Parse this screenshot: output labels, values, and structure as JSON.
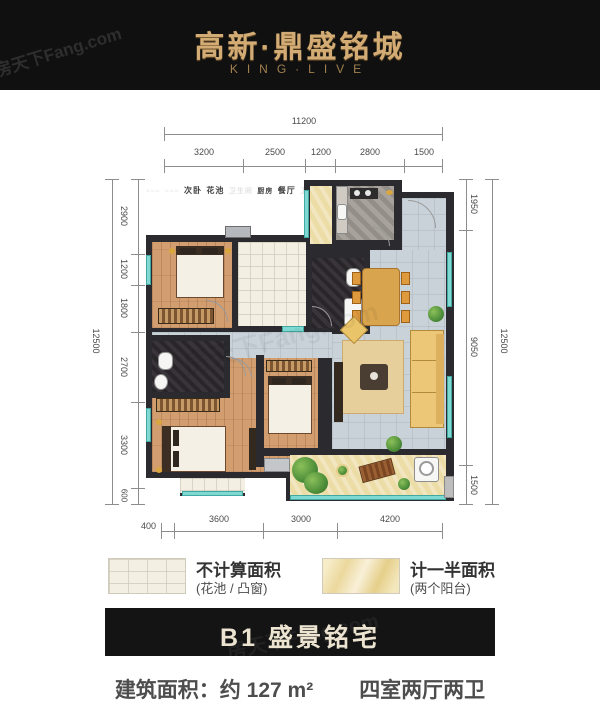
{
  "watermark": "房天下Fang.com",
  "header": {
    "title": "高新·鼎盛铭城",
    "subtitle": "KING·LIVE"
  },
  "dims": {
    "top": {
      "total": "11200",
      "segments": [
        "3200",
        "2500",
        "1200",
        "2800",
        "1500"
      ]
    },
    "left": {
      "total": "12500",
      "segments": [
        "2900",
        "1200",
        "1800",
        "2700",
        "3300",
        "600"
      ]
    },
    "right": {
      "total": "12500",
      "segments": [
        "1950",
        "9050",
        "1500"
      ]
    },
    "bottom": {
      "segments": [
        "400",
        "3600",
        "3000",
        "4200"
      ]
    }
  },
  "rooms": {
    "bedroom_top": "次卧",
    "flower_bed": "花池",
    "bath_top": "卫生间",
    "kitchen": "厨房",
    "dining": "餐厅",
    "bath_left": "卫生间",
    "master": "主卧",
    "bedroom_mid": "次卧",
    "living": "客厅",
    "balcony": "阳台",
    "bay_window": "凸窗"
  },
  "legend": [
    {
      "title": "不计算面积",
      "subtitle": "(花池 / 凸窗)"
    },
    {
      "title": "计一半面积",
      "subtitle": "(两个阳台)"
    }
  ],
  "banner": {
    "label": "B1 盛景铭宅"
  },
  "footer": {
    "area": "建筑面积：约 127 m²",
    "rooms_desc": "四室两厅两卫"
  }
}
